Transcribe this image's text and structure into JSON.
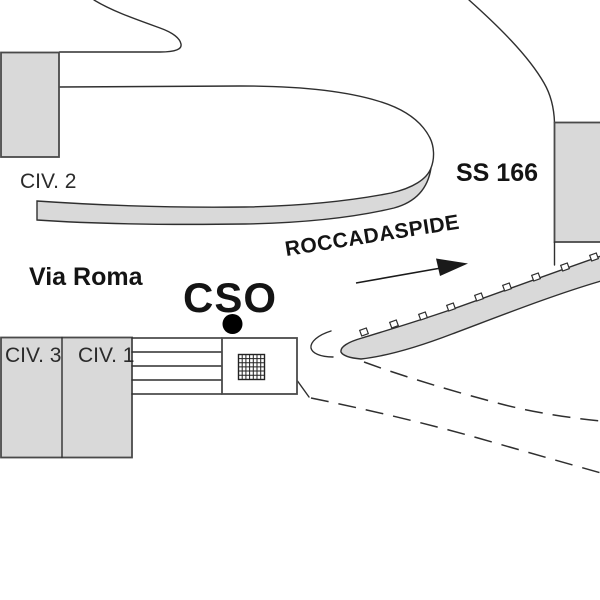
{
  "map": {
    "labels": {
      "civ2": "CIV. 2",
      "civ3": "CIV. 3",
      "civ1": "CIV. 1",
      "via_roma": "Via Roma",
      "cso": "CSO",
      "ss166": "SS 166",
      "direction": "ROCCADASPIDE"
    },
    "colors": {
      "background": "#ffffff",
      "surface_gray": "#d9d9d9",
      "line": "#2f2f2f",
      "text": "#141414",
      "marker": "#000000"
    },
    "marker": {
      "icon": "location-dot",
      "building_icon": "hatched-grid-square"
    }
  }
}
